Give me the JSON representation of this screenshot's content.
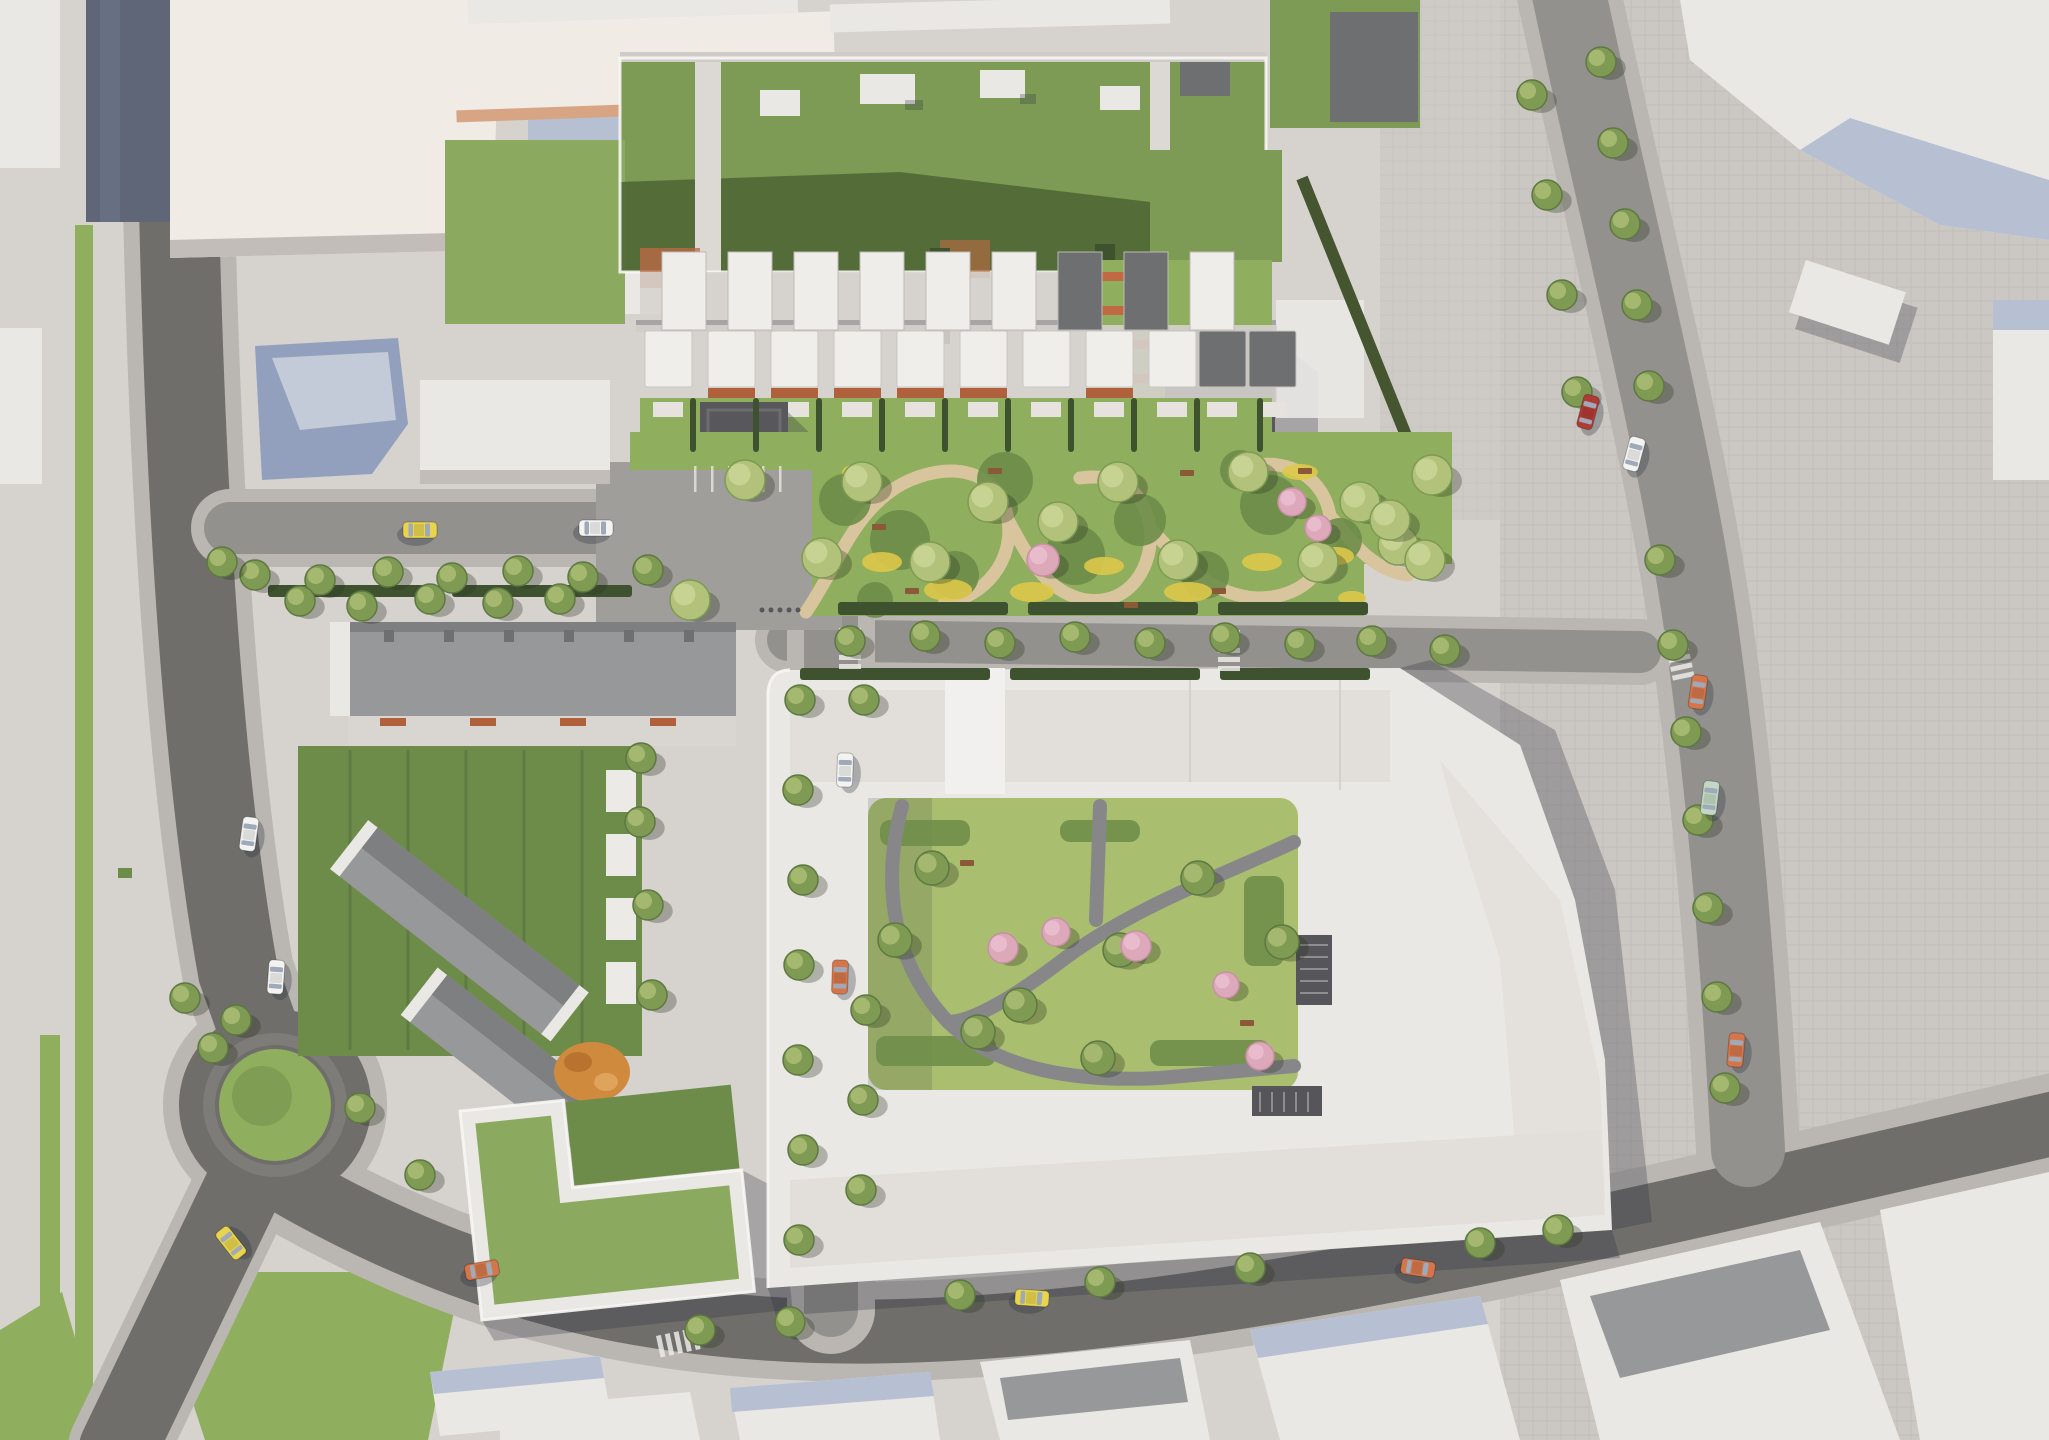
{
  "scene": {
    "kind": "aerial-architectural-masterplan-render",
    "palette": {
      "pavement": "#d6d2ce",
      "plaza": "#cbc7c3",
      "sidewalk": "#bab6b2",
      "asphalt_dark": "#6f6e6b",
      "asphalt_mid": "#93918d",
      "building_white": "#eae8e5",
      "building_cream": "#f0ebe5",
      "facet_blue": "#93a0bd",
      "facet_blue_light": "#b7c0d3",
      "context_dark": "#5f6677",
      "roof_gray": "#97989a",
      "roof_dark": "#6e6f71",
      "dark_building": "#58585c",
      "green_roof": "#7d9b54",
      "green_roof_light": "#8caa5f",
      "green_shadow": "#4b6434",
      "lawn": "#8fae5e",
      "lawn_lime": "#a9be6e",
      "lawn_dark": "#6d8c49",
      "hedge": "#3f5230",
      "tree": "#7f9a52",
      "tree_light": "#b2c27b",
      "tree_dark": "#5d7840",
      "tree_pink": "#dca8ba",
      "tree_pink_light": "#ecc3d1",
      "sand": "#d9c59d",
      "flowers": "#ddc84a",
      "terracotta": "#c06a44",
      "brick": "#b0603a",
      "playground": "#d08a3e",
      "path_gray": "#87878a",
      "white_line": "#f7f6f4",
      "shadow": "rgba(42,48,62,0.28)",
      "car_white": "#f3f3f2",
      "car_taxi": "#e8d44d",
      "car_orange": "#d4764a",
      "car_red": "#b03a34",
      "car_mint": "#c2d8c4"
    },
    "cars": [
      {
        "x": 249,
        "y": 834,
        "a": 8,
        "c": "car_white"
      },
      {
        "x": 276,
        "y": 977,
        "a": 4,
        "c": "car_white"
      },
      {
        "x": 231,
        "y": 1243,
        "a": -38,
        "c": "car_taxi"
      },
      {
        "x": 482,
        "y": 1270,
        "a": 80,
        "c": "car_orange"
      },
      {
        "x": 420,
        "y": 530,
        "a": 90,
        "c": "car_taxi"
      },
      {
        "x": 596,
        "y": 528,
        "a": 90,
        "c": "car_white"
      },
      {
        "x": 845,
        "y": 770,
        "a": 2,
        "c": "car_white"
      },
      {
        "x": 840,
        "y": 977,
        "a": 2,
        "c": "car_orange"
      },
      {
        "x": 1032,
        "y": 1298,
        "a": 94,
        "c": "car_taxi"
      },
      {
        "x": 1418,
        "y": 1268,
        "a": 99,
        "c": "car_orange"
      },
      {
        "x": 1588,
        "y": 412,
        "a": 15,
        "c": "car_red"
      },
      {
        "x": 1634,
        "y": 454,
        "a": 15,
        "c": "car_white"
      },
      {
        "x": 1698,
        "y": 692,
        "a": 8,
        "c": "car_orange"
      },
      {
        "x": 1710,
        "y": 798,
        "a": 7,
        "c": "car_mint"
      },
      {
        "x": 1736,
        "y": 1050,
        "a": 5,
        "c": "car_orange"
      }
    ],
    "trees_street": [
      [
        255,
        575
      ],
      [
        320,
        580
      ],
      [
        388,
        572
      ],
      [
        452,
        578
      ],
      [
        518,
        571
      ],
      [
        583,
        577
      ],
      [
        648,
        570
      ],
      [
        850,
        641
      ],
      [
        925,
        636
      ],
      [
        1000,
        643
      ],
      [
        1075,
        637
      ],
      [
        1150,
        643
      ],
      [
        1225,
        638
      ],
      [
        1300,
        644
      ],
      [
        1372,
        641
      ],
      [
        1445,
        650
      ],
      [
        800,
        700
      ],
      [
        798,
        790
      ],
      [
        803,
        880
      ],
      [
        799,
        965
      ],
      [
        798,
        1060
      ],
      [
        803,
        1150
      ],
      [
        799,
        1240
      ],
      [
        864,
        700
      ],
      [
        866,
        1010
      ],
      [
        863,
        1100
      ],
      [
        861,
        1190
      ],
      [
        960,
        1295
      ],
      [
        1100,
        1282
      ],
      [
        1250,
        1268
      ],
      [
        1480,
        1243
      ],
      [
        1558,
        1230
      ],
      [
        1660,
        560
      ],
      [
        1673,
        645
      ],
      [
        1686,
        732
      ],
      [
        1698,
        820
      ],
      [
        1708,
        908
      ],
      [
        1717,
        997
      ],
      [
        1725,
        1088
      ],
      [
        1601,
        62
      ],
      [
        1613,
        143
      ],
      [
        1625,
        224
      ],
      [
        1637,
        305
      ],
      [
        1649,
        386
      ],
      [
        1532,
        95
      ],
      [
        1547,
        195
      ],
      [
        1562,
        295
      ],
      [
        1577,
        392
      ],
      [
        222,
        562
      ],
      [
        236,
        1020
      ],
      [
        185,
        998
      ],
      [
        213,
        1048
      ],
      [
        300,
        601
      ],
      [
        362,
        606
      ],
      [
        430,
        599
      ],
      [
        498,
        603
      ],
      [
        560,
        599
      ],
      [
        640,
        822
      ],
      [
        648,
        905
      ],
      [
        652,
        995
      ],
      [
        641,
        758
      ],
      [
        700,
        1330
      ],
      [
        790,
        1322
      ],
      [
        420,
        1175
      ],
      [
        360,
        1108
      ]
    ],
    "trees_park": [
      [
        822,
        558
      ],
      [
        862,
        482
      ],
      [
        930,
        562
      ],
      [
        988,
        502
      ],
      [
        1058,
        522
      ],
      [
        1118,
        482
      ],
      [
        1178,
        560
      ],
      [
        1248,
        472
      ],
      [
        1318,
        562
      ],
      [
        1360,
        502
      ],
      [
        1398,
        545
      ],
      [
        1432,
        475
      ],
      [
        690,
        600
      ],
      [
        745,
        480
      ],
      [
        1390,
        520
      ],
      [
        1425,
        560
      ]
    ],
    "trees_courtyard": [
      [
        932,
        868
      ],
      [
        978,
        1032
      ],
      [
        1098,
        1058
      ],
      [
        1198,
        878
      ],
      [
        1282,
        942
      ],
      [
        1120,
        950
      ],
      [
        1020,
        1005
      ],
      [
        895,
        940
      ]
    ],
    "trees_pink": [
      [
        1043,
        560,
        16
      ],
      [
        1292,
        502,
        14
      ],
      [
        1318,
        528,
        13
      ],
      [
        1003,
        948,
        15
      ],
      [
        1056,
        932,
        14
      ],
      [
        1136,
        946,
        15
      ],
      [
        1226,
        985,
        13
      ],
      [
        1260,
        1056,
        14
      ]
    ],
    "shrubs": [
      [
        845,
        500,
        26
      ],
      [
        900,
        540,
        30
      ],
      [
        955,
        575,
        24
      ],
      [
        1005,
        480,
        28
      ],
      [
        1075,
        555,
        30
      ],
      [
        1140,
        520,
        26
      ],
      [
        1205,
        575,
        24
      ],
      [
        1270,
        505,
        30
      ],
      [
        1340,
        540,
        22
      ],
      [
        875,
        600,
        18
      ],
      [
        1240,
        470,
        20
      ]
    ],
    "flowers": [
      [
        882,
        562,
        20,
        10
      ],
      [
        948,
        590,
        24,
        11
      ],
      [
        1032,
        592,
        22,
        10
      ],
      [
        1104,
        566,
        20,
        9
      ],
      [
        1188,
        592,
        24,
        10
      ],
      [
        1262,
        562,
        20,
        9
      ],
      [
        1336,
        556,
        18,
        9
      ],
      [
        1392,
        522,
        16,
        8
      ],
      [
        858,
        472,
        16,
        8
      ],
      [
        1300,
        472,
        18,
        8
      ],
      [
        1352,
        598,
        14,
        7
      ]
    ],
    "sand_paths": [
      "M 806 612 C 838 566 852 512 902 484 C 948 460 1000 468 1008 520 C 1014 560 986 596 944 604",
      "M 1008 520 C 1030 560 1046 592 1086 600 C 1130 606 1154 566 1150 528 C 1146 494 1120 472 1080 478",
      "M 1150 528 C 1180 560 1210 596 1258 598 C 1310 598 1336 560 1330 516 C 1324 478 1290 458 1250 466",
      "M 1330 516 C 1352 540 1370 570 1408 575"
    ],
    "courtyard_paths": [
      "M 902 806 C 882 880 890 960 948 1022 C 1000 1072 1080 1082 1160 1078 L 1294 1066",
      "M 1294 842 C 1230 872 1130 908 1060 962 C 1010 1000 970 1022 948 1022",
      "M 1100 806 L 1096 920"
    ],
    "courtyard_beds": [
      [
        880,
        820,
        90,
        26
      ],
      [
        876,
        1036,
        120,
        30
      ],
      [
        1150,
        1040,
        120,
        26
      ],
      [
        1244,
        876,
        40,
        90
      ],
      [
        1060,
        820,
        80,
        22
      ]
    ],
    "hedges": [
      [
        838,
        602,
        170,
        13
      ],
      [
        1028,
        602,
        170,
        13
      ],
      [
        1218,
        602,
        150,
        13
      ],
      [
        268,
        585,
        170,
        12
      ],
      [
        452,
        585,
        180,
        12
      ],
      [
        800,
        668,
        190,
        12
      ],
      [
        1010,
        668,
        190,
        12
      ],
      [
        1220,
        668,
        150,
        12
      ],
      [
        690,
        398,
        6,
        54
      ],
      [
        753,
        398,
        6,
        54
      ],
      [
        816,
        398,
        6,
        54
      ],
      [
        879,
        398,
        6,
        54
      ],
      [
        942,
        398,
        6,
        54
      ],
      [
        1005,
        398,
        6,
        54
      ],
      [
        1068,
        398,
        6,
        54
      ],
      [
        1131,
        398,
        6,
        54
      ],
      [
        1194,
        398,
        6,
        54
      ],
      [
        1257,
        398,
        6,
        54
      ]
    ],
    "benches": [
      [
        905,
        588
      ],
      [
        988,
        468
      ],
      [
        1212,
        588
      ],
      [
        1298,
        468
      ],
      [
        1124,
        602
      ],
      [
        872,
        524
      ],
      [
        1180,
        470
      ],
      [
        960,
        860
      ],
      [
        1240,
        1020
      ]
    ],
    "crossings": [
      {
        "x": 861,
        "y": 628,
        "a": 90
      },
      {
        "x": 1240,
        "y": 630,
        "a": 90
      },
      {
        "x": 656,
        "y": 1336,
        "a": -12
      },
      {
        "x": 1686,
        "y": 636,
        "a": 78
      }
    ],
    "parking_ticks": {
      "x": 694,
      "y": 466,
      "step": 17,
      "count": 6,
      "h": 26
    },
    "bike_racks": {
      "x": 762,
      "y": 610,
      "step": 9,
      "count": 5
    },
    "mews_houses": [
      {
        "x": 645,
        "dark": false,
        "brick": false
      },
      {
        "x": 708,
        "dark": false,
        "brick": true
      },
      {
        "x": 771,
        "dark": false,
        "brick": true
      },
      {
        "x": 834,
        "dark": false,
        "brick": true
      },
      {
        "x": 897,
        "dark": false,
        "brick": true
      },
      {
        "x": 960,
        "dark": false,
        "brick": true
      },
      {
        "x": 1023,
        "dark": false,
        "brick": false
      },
      {
        "x": 1086,
        "dark": false,
        "brick": true
      },
      {
        "x": 1149,
        "dark": false,
        "brick": false
      },
      {
        "x": 1199,
        "dark": true,
        "brick": false
      },
      {
        "x": 1249,
        "dark": true,
        "brick": false
      }
    ],
    "roof_units": [
      {
        "x": 662,
        "dark": false
      },
      {
        "x": 728,
        "dark": false
      },
      {
        "x": 794,
        "dark": false
      },
      {
        "x": 860,
        "dark": false
      },
      {
        "x": 926,
        "dark": false
      },
      {
        "x": 992,
        "dark": false
      },
      {
        "x": 1058,
        "dark": true
      },
      {
        "x": 1124,
        "dark": true
      },
      {
        "x": 1190,
        "dark": false
      }
    ],
    "patios_sw": [
      [
        606,
        770
      ],
      [
        606,
        834
      ],
      [
        606,
        898
      ],
      [
        606,
        962
      ]
    ]
  }
}
